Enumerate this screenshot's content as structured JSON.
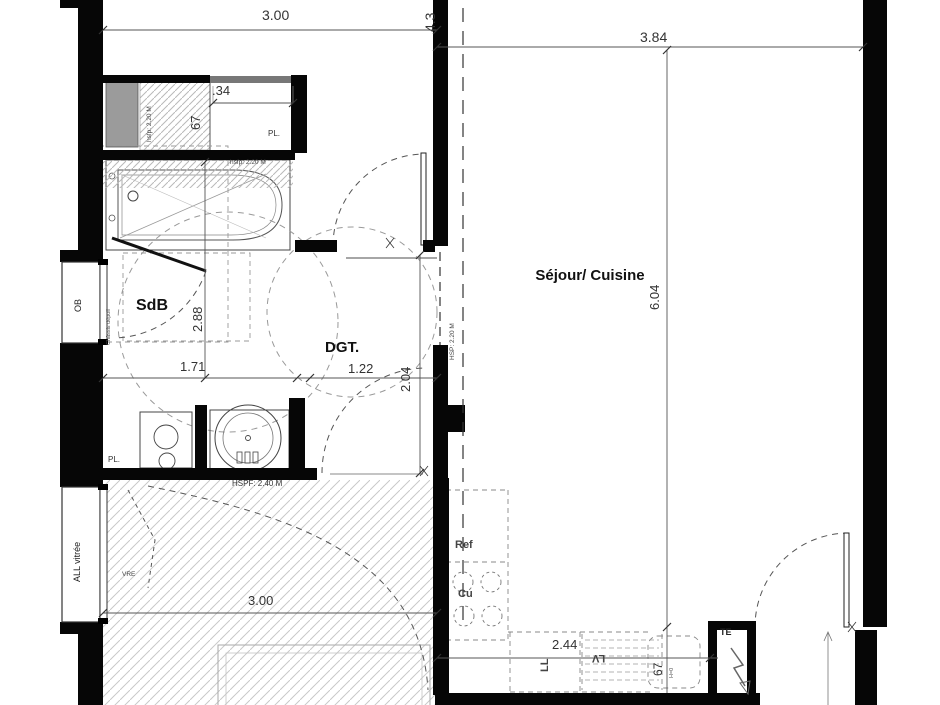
{
  "rooms": {
    "sdb": "SdB",
    "dgt": "DGT.",
    "sejour": "Séjour/ Cuisine"
  },
  "dims": {
    "top_width": "3.00",
    "left_wall_v": "4.3",
    "sejour_width": "3.84",
    "closet_width": ".34",
    "closet_depth": "67",
    "sdb_height": "2.88",
    "sdb_width": "1.71",
    "dgt_width": "1.22",
    "dgt_height": "2.04",
    "sejour_height": "6.04",
    "lower_room_width": "3.00",
    "counter_width": "2.44",
    "counter_depth": "67"
  },
  "heights": {
    "closet": "hsfp: 2.20 M",
    "bath": "hsfp: 2.20 M",
    "sejour": "HSP: 2.20 M",
    "lower_room": "HSPF: 2.40 M"
  },
  "openings": {
    "ob_window": "OB",
    "glazed_window": "ALL vitrée",
    "chassis_note": "Châssis dépoli",
    "shutter": "VRE"
  },
  "fixtures": {
    "closet_top": "PL.",
    "closet_bath": "PL.",
    "fridge": "Ref",
    "cooktop": "Cu",
    "washer": "LL",
    "dishwasher": "LV",
    "electrical_panel": "TE",
    "sink_note": "H=0"
  }
}
